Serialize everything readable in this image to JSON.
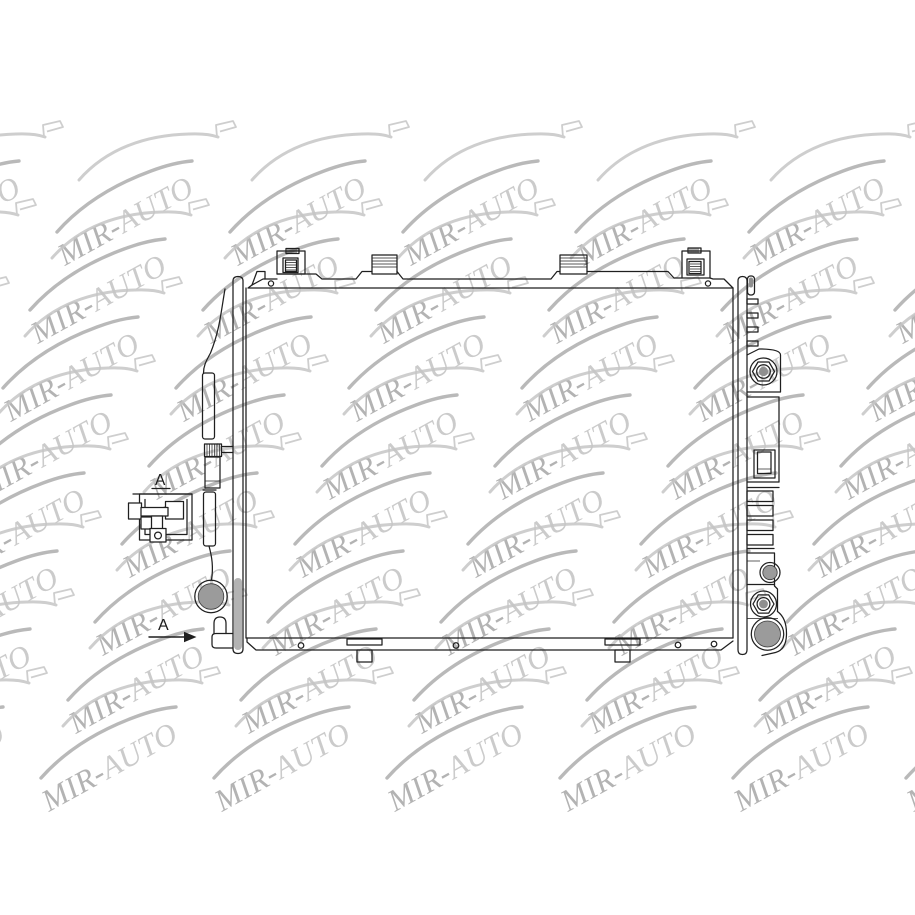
{
  "page": {
    "description": "Technical line drawing of an automotive radiator, product catalog image",
    "background_color": "#ffffff"
  },
  "watermark": {
    "brand_full": "MIR-AUTO",
    "brand_first": "MIR-",
    "brand_second": "AUTO",
    "text_color_first": "#a6a6a6",
    "text_color_second": "#c3c3c3",
    "car_color": "#c6c6c6",
    "car_accent_color": "#adadad",
    "angle_deg": -29,
    "opacity": 0.85,
    "grid": {
      "origin_x": 77,
      "origin_y": 128,
      "col_pitch": 173,
      "row_pitch": 78,
      "row_x_drift": -27,
      "rows": 8,
      "cols_from": -2,
      "cols_to": 6
    }
  },
  "annotations": {
    "detail_view_label": "A",
    "section_arrow_label": "A",
    "label_color": "#1a1a1a"
  },
  "drawing": {
    "subject": "radiator",
    "line_color": "#1f1f1f",
    "port_fill_color": "#9b9b9b",
    "fitting_core_color": "#8f8f8f",
    "side_plate_shade_color": "#b3b3b3"
  }
}
